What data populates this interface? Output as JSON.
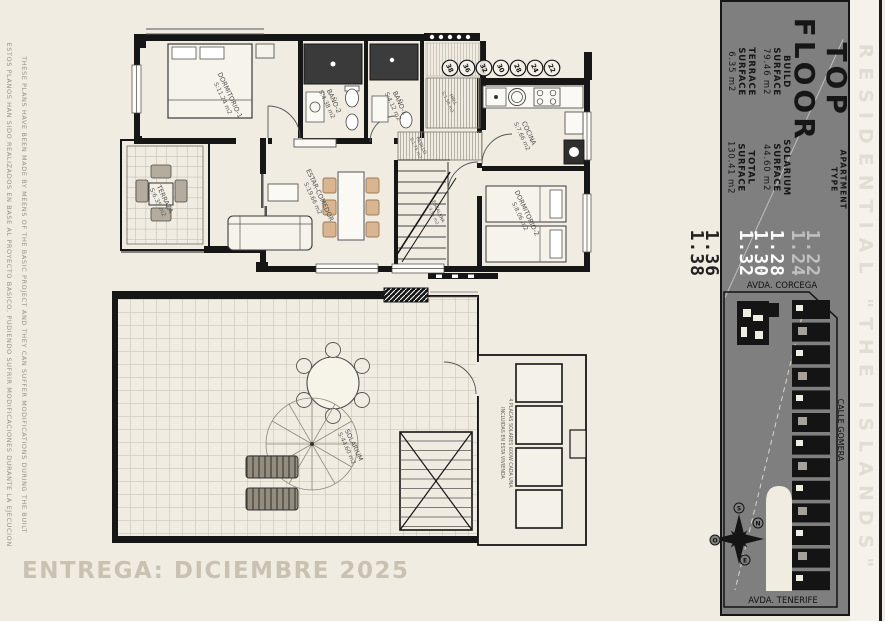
{
  "sheet": {
    "disclaimer_en": "THESE PLANS HAVE BEEN MADE BY MEENS OF THE BASIC PROJECT AND THEY CAN SUFFER MODIFICATIONS DURING THE BUILT",
    "disclaimer_es": "ESTOS PLANOS HAN SIDO REALIZADOS EN BASE AL PROYECTO BASICO, PUDIENDO SUFRIR MODIFICACIONES DURANTE LA EJECUCION",
    "delivery": "ENTREGA: DICIEMBRE 2025"
  },
  "panel": {
    "floor_title": "TOP\nFLOOR",
    "apartment_type_label": "APARTMENT\nTYPE",
    "types": [
      "1.22",
      "1.24",
      "1.28",
      "1.30",
      "1.32",
      "1.36",
      "1.38"
    ],
    "surfaces": [
      {
        "label": "BUILD\nSURFACE",
        "value": "79.46 m2"
      },
      {
        "label": "SOLARIUM\nSURFACE",
        "value": "44.60 m2"
      },
      {
        "label": "TERRACE\nSURFACE",
        "value": "6.35 m2"
      },
      {
        "label": "TOTAL\nSURFACE",
        "value": "130.41 m2"
      }
    ],
    "brand": "RESIDENTIAL \"THE ISLANDS\"",
    "site": {
      "street_top": "AVDA. CORCEGA",
      "street_right": "CALLE GOMERA",
      "street_bottom": "AVDA. TENERIFE",
      "compass": {
        "n": "N",
        "s": "S",
        "e": "E",
        "o": "O"
      }
    }
  },
  "plan_top": {
    "rooms": [
      {
        "name": "DORMITORIO-1",
        "area": "S:11.24 m2"
      },
      {
        "name": "TERRAZA",
        "area": "S:6.35 m2"
      },
      {
        "name": "BAÑO-2",
        "area": "S:4.38 m2"
      },
      {
        "name": "BAÑO-1",
        "area": "S:4.12 m2"
      },
      {
        "name": "HALL",
        "area": "S:1.50 m2"
      },
      {
        "name": "PASILLO",
        "area": "S:1.75 m2"
      },
      {
        "name": "ESCALERA",
        "area": "S:3.54 m2"
      },
      {
        "name": "COCINA",
        "area": "S:7.66 m2"
      },
      {
        "name": "ESTAR-COMEDOR",
        "area": "S:19.66 m2"
      },
      {
        "name": "DORMITORIO-2",
        "area": "S:8.06 m2"
      }
    ],
    "unit_circles": [
      "38",
      "36",
      "32",
      "30",
      "28",
      "24",
      "22"
    ]
  },
  "plan_bottom": {
    "solarium": {
      "name": "SOLARIUM",
      "area": "S:44.60 m2"
    },
    "solar_note_l1": "4 PLACAS SOLARES 600W CADA UNA",
    "solar_note_l2": "INCLUIDAS EN ESTA VIVIENDA"
  }
}
